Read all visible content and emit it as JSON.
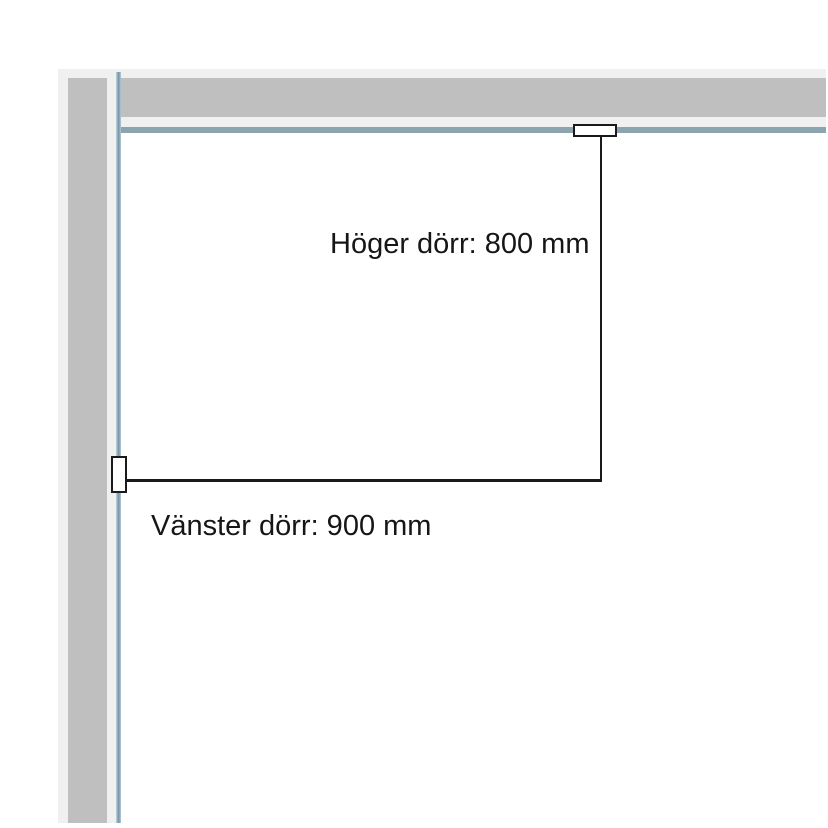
{
  "diagram": {
    "type": "floor-plan-door-measurements",
    "labels": {
      "right_door": "Höger dörr: 800 mm",
      "left_door": "Vänster dörr: 900 mm"
    },
    "measurements": {
      "right_door_mm": "800",
      "left_door_mm": "900"
    },
    "colors": {
      "wall_gray": "#bfbfbf",
      "wall_edge_light": "#f0f0f1",
      "rail_blue": "#8ba4ae",
      "rail_blue_dark": "#7394a8",
      "line_black": "#1a1a1a",
      "marker_fill": "#ffffff"
    }
  }
}
